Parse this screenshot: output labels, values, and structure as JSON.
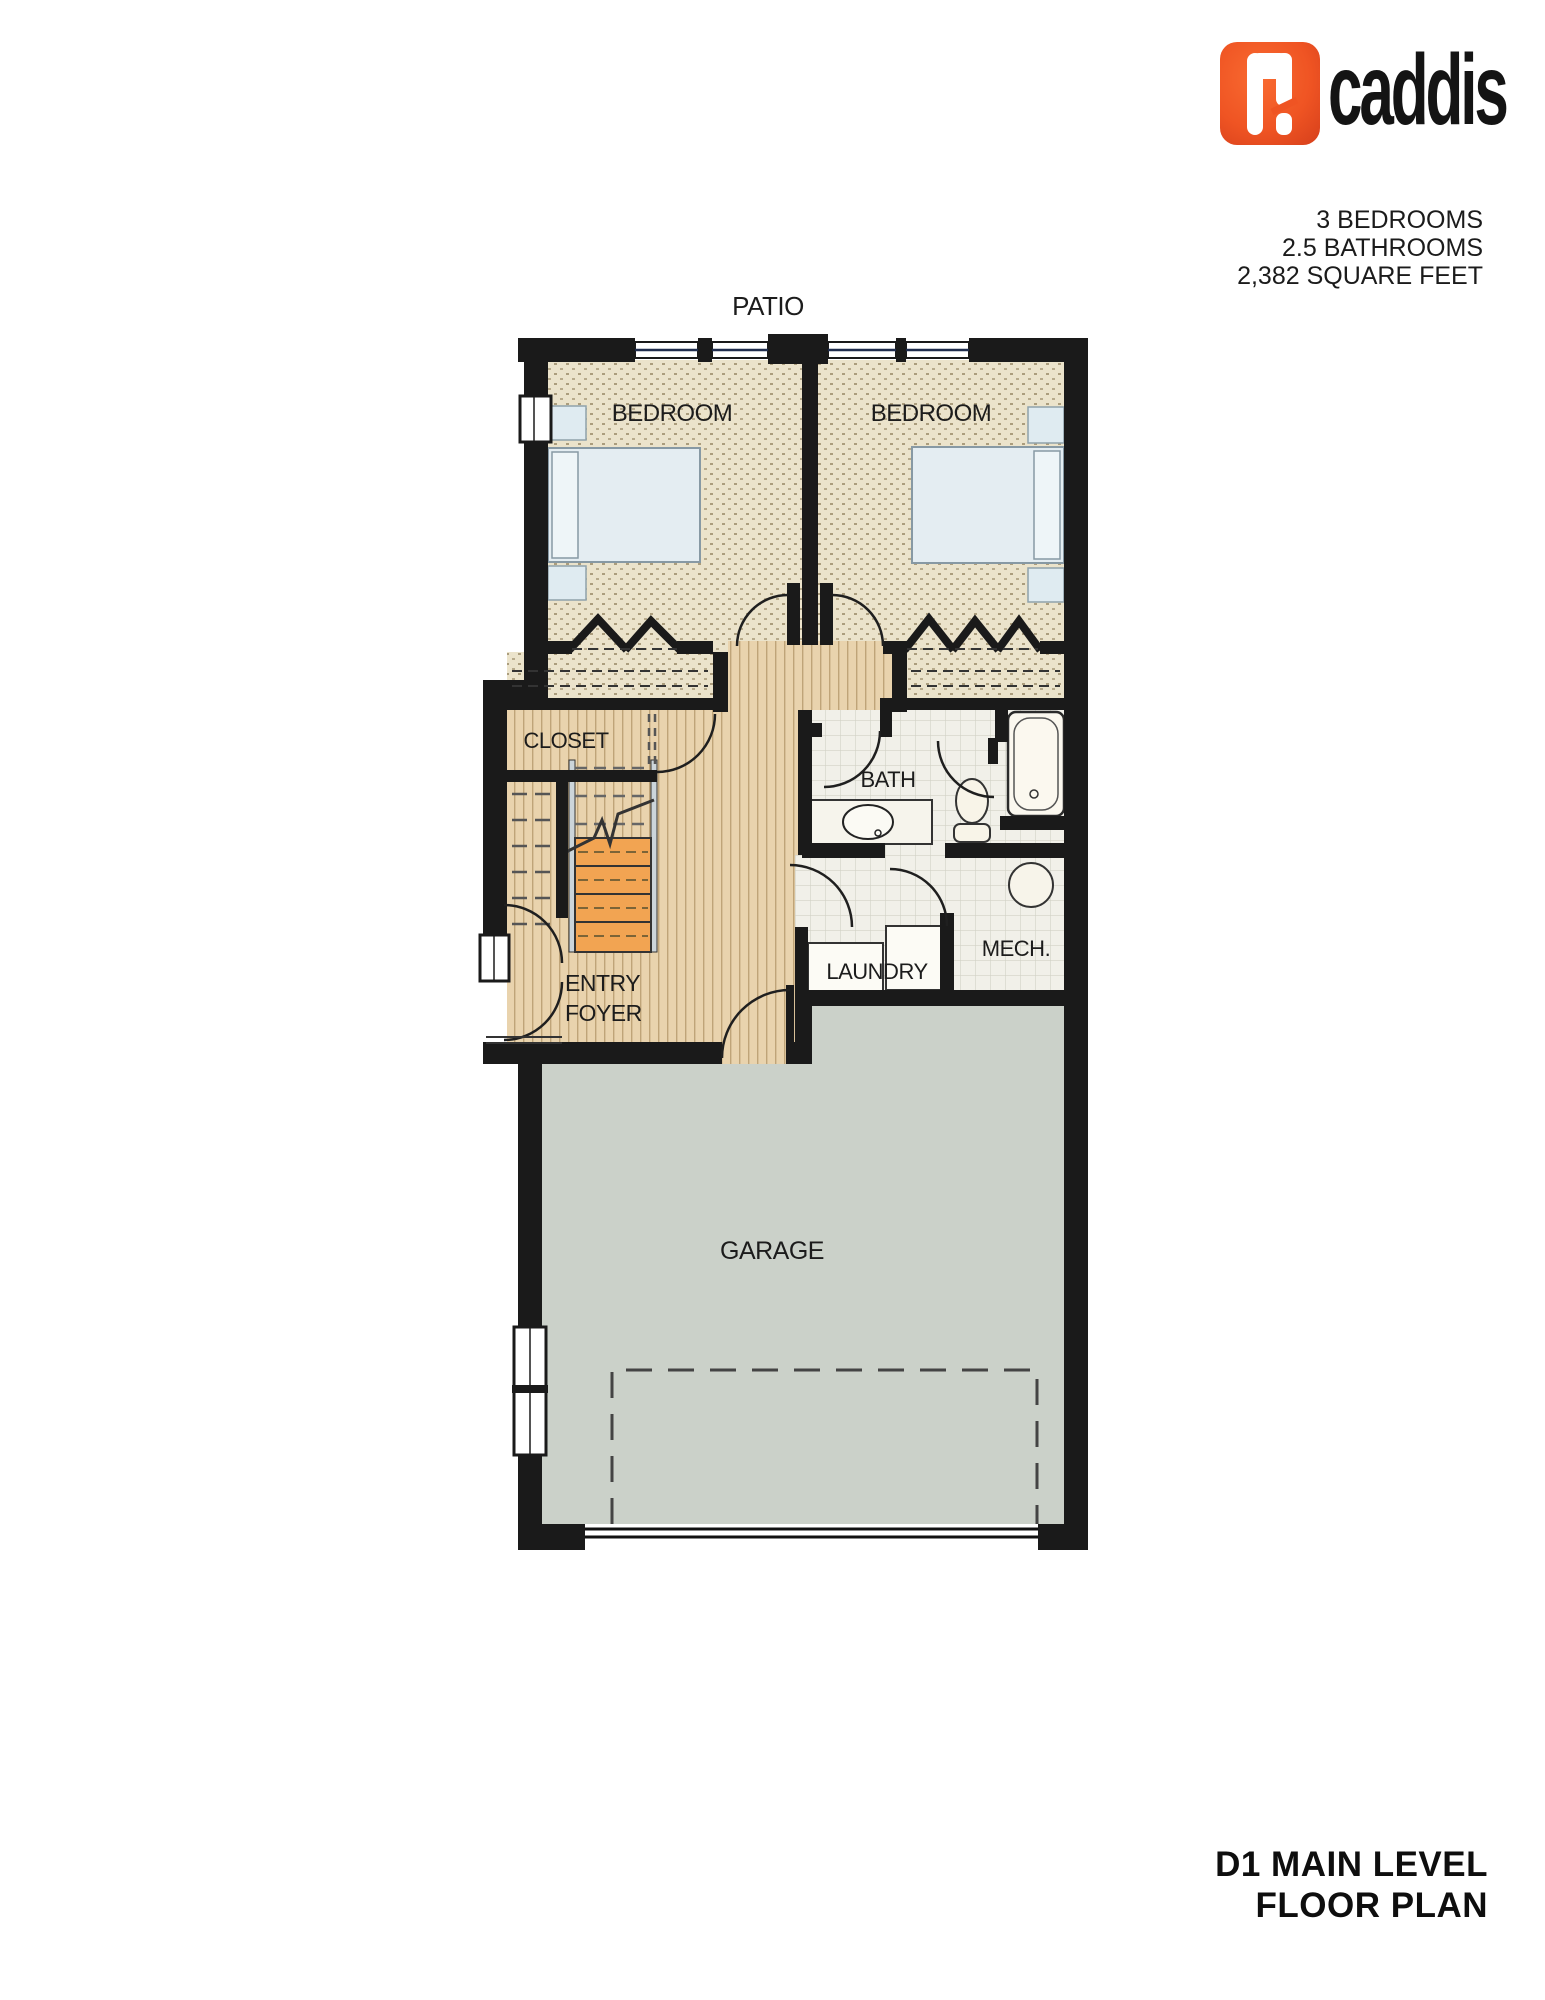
{
  "brand": {
    "name": "caddis",
    "logo_color": "#f05a28"
  },
  "summary": {
    "bedrooms": "3 BEDROOMS",
    "bathrooms": "2.5 BATHROOMS",
    "area": "2,382 SQUARE FEET"
  },
  "plan": {
    "labels": {
      "patio": "PATIO",
      "bedroom_left": "BEDROOM",
      "bedroom_right": "BEDROOM",
      "closet": "CLOSET",
      "bath": "BATH",
      "entry_line1": "ENTRY",
      "entry_line2": "FOYER",
      "laundry": "LAUNDRY",
      "mech": "MECH.",
      "garage": "GARAGE"
    }
  },
  "footer": {
    "line1": "D1 MAIN LEVEL",
    "line2": "FLOOR PLAN"
  },
  "colors": {
    "wall": "#1a1a1a",
    "carpet": "#ebe3cb",
    "wood": "#e9d3ad",
    "tile": "#f1f0e9",
    "concrete": "#cbd1c9",
    "stair_tread": "#f2a452",
    "window_line": "#1f2c4d",
    "accent_orange": "#f05a28"
  }
}
